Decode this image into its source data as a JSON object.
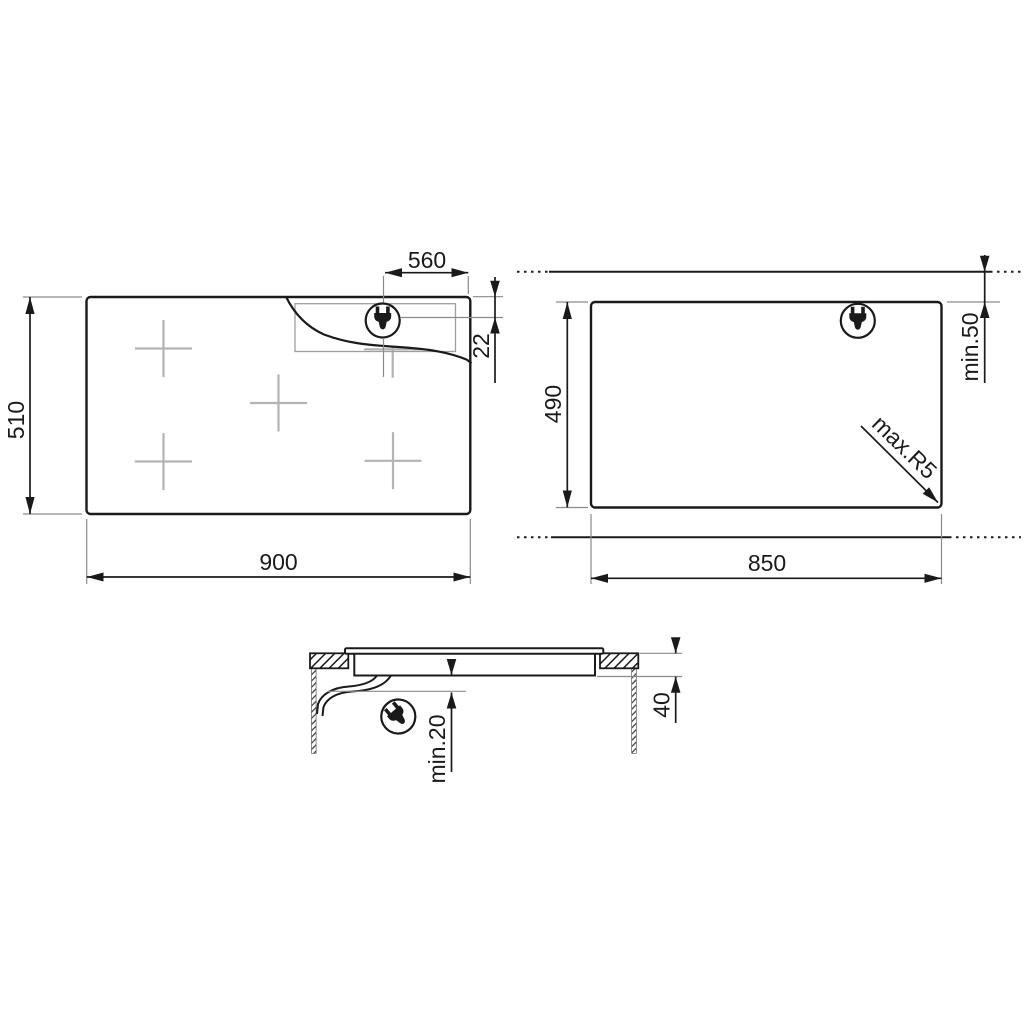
{
  "background": "#ffffff",
  "colors": {
    "line": "#1a1a1a",
    "muted": "#8a8a8a",
    "cross": "#b3b3b3"
  },
  "views": {
    "top": {
      "title": "hob top view",
      "width": "900",
      "height": "510",
      "plug_offset": "560",
      "plug_inset": "22"
    },
    "cutout": {
      "title": "worktop cutout view",
      "width": "850",
      "height": "490",
      "rear_clearance": "min.50",
      "corner_radius": "max.R5"
    },
    "side": {
      "title": "side section view",
      "clearance_below": "min.20",
      "recess_depth": "40"
    }
  }
}
